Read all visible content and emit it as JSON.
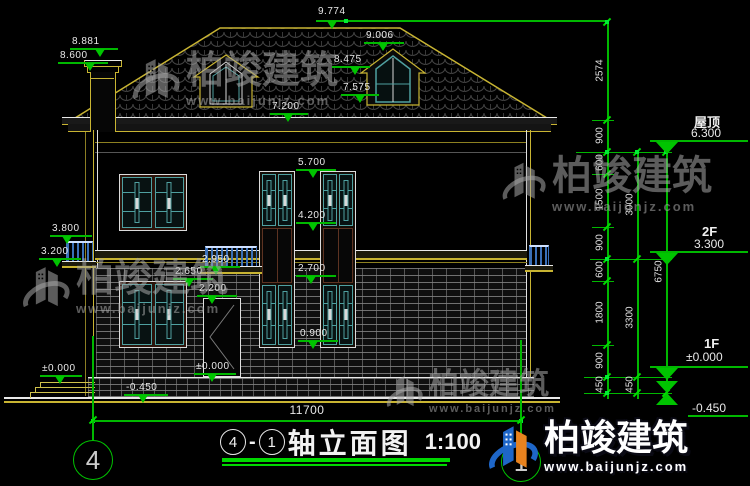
{
  "drawing": {
    "title": {
      "axis_start": "4",
      "sep": "-",
      "axis_end": "1",
      "name": "轴立面图",
      "scale": "1:100"
    },
    "grid_bubbles": {
      "left": "4",
      "right": "1"
    },
    "annotations": {
      "v9774": "9.774",
      "v8881": "8.881",
      "v8600": "8.600",
      "v9006": "9.006",
      "v8475": "8.475",
      "v7575": "7.575",
      "v7200": "7.200",
      "v5700": "5.700",
      "v4200": "4.200",
      "v3800": "3.800",
      "v3200": "3.200",
      "v2950": "2.950",
      "v2650": "2.650",
      "v2200": "2.200",
      "v2700": "2.700",
      "v0900": "0.900",
      "zero_left": "±0.000",
      "zero_door": "±0.000",
      "neg450_left": "-0.450"
    },
    "right_levels": {
      "roof_label": "屋顶",
      "roof_elev": "6.300",
      "f2_label": "2F",
      "f2_elev": "3.300",
      "f1_label": "1F",
      "f1_elev": "±0.000",
      "ground_elev": "-0.450"
    },
    "dims": {
      "inner": [
        "2574",
        "900",
        "600",
        "1500",
        "900",
        "600",
        "1800",
        "900",
        "450"
      ],
      "mid": [
        "3000",
        "3300",
        "450"
      ],
      "outer": [
        "6750"
      ],
      "width": "11700"
    },
    "watermark": {
      "brand": "柏竣建筑",
      "url": "www.baijunjz.com"
    },
    "colors": {
      "line_green": "#00b800",
      "cad_yellow": "#c8b432",
      "lattice_teal": "#4fa0a0",
      "railing_blue": "#3a70b8",
      "logo_blue": "#1e66c8",
      "logo_orange": "#e8821e"
    }
  }
}
